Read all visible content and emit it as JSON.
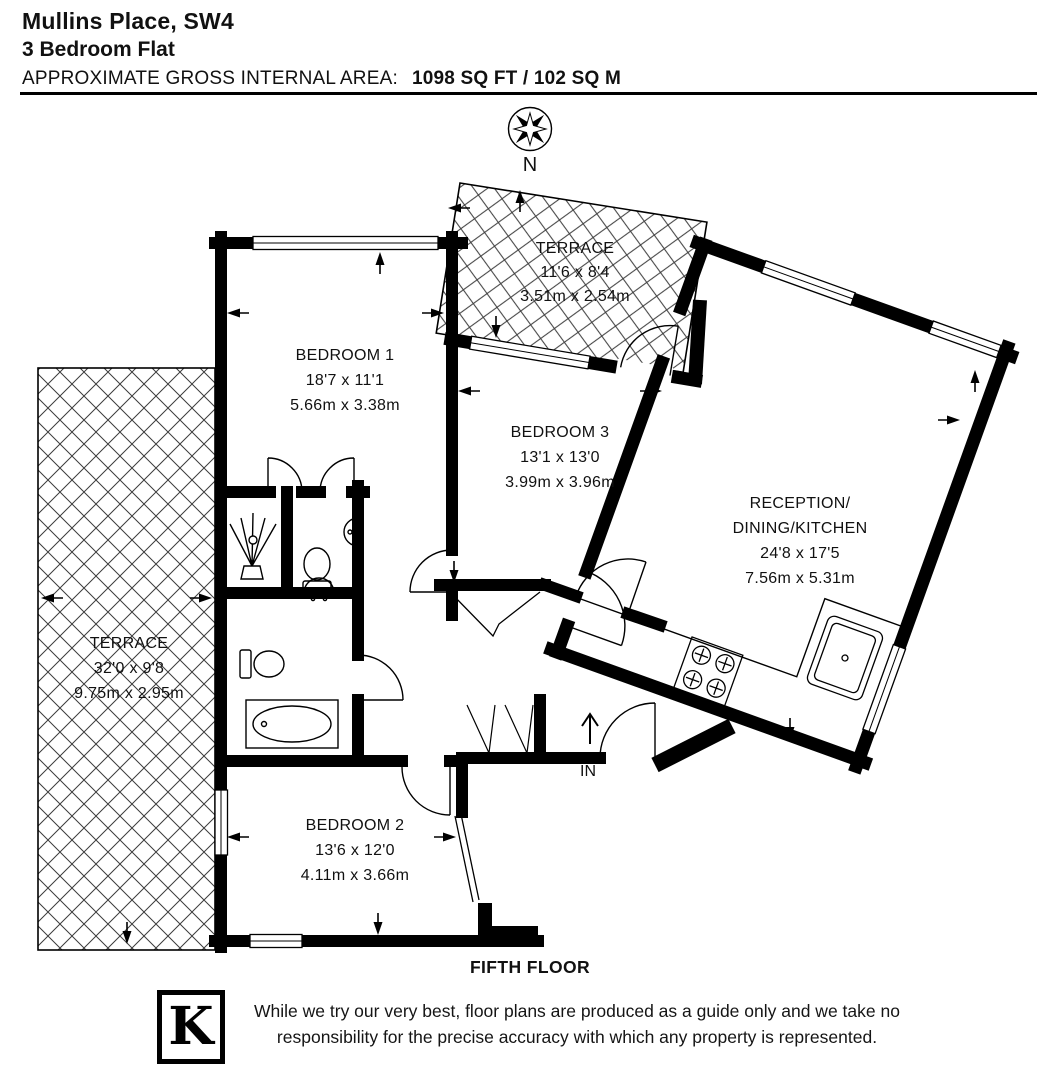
{
  "header": {
    "title": "Mullins Place, SW4",
    "subtitle": "3 Bedroom Flat",
    "area_label": "APPROXIMATE GROSS INTERNAL AREA:",
    "area_value": "1098 SQ FT / 102 SQ M"
  },
  "compass": {
    "north_label": "N"
  },
  "floorplan": {
    "floor_label": "FIFTH FLOOR",
    "entrance_label": "IN",
    "rooms": [
      {
        "id": "terrace-top",
        "name": "TERRACE",
        "imperial": "11'6 x 8'4",
        "metric": "3.51m x 2.54m"
      },
      {
        "id": "bedroom-1",
        "name": "BEDROOM 1",
        "imperial": "18'7 x 11'1",
        "metric": "5.66m x 3.38m"
      },
      {
        "id": "bedroom-3",
        "name": "BEDROOM 3",
        "imperial": "13'1 x 13'0",
        "metric": "3.99m x 3.96m"
      },
      {
        "id": "reception",
        "name_line1": "RECEPTION/",
        "name_line2": "DINING/KITCHEN",
        "imperial": "24'8 x 17'5",
        "metric": "7.56m x 5.31m"
      },
      {
        "id": "terrace-left",
        "name": "TERRACE",
        "imperial": "32'0 x 9'8",
        "metric": "9.75m x 2.95m"
      },
      {
        "id": "bedroom-2",
        "name": "BEDROOM 2",
        "imperial": "13'6 x 12'0",
        "metric": "4.11m x 3.66m"
      }
    ]
  },
  "footer": {
    "logo_letter": "K",
    "disclaimer_line1": "While we try our very best, floor plans are produced as a guide only and we take no",
    "disclaimer_line2": "responsibility for the precise accuracy with which any property is represented."
  },
  "colors": {
    "wall": "#000000",
    "background": "#ffffff",
    "text": "#111111"
  }
}
